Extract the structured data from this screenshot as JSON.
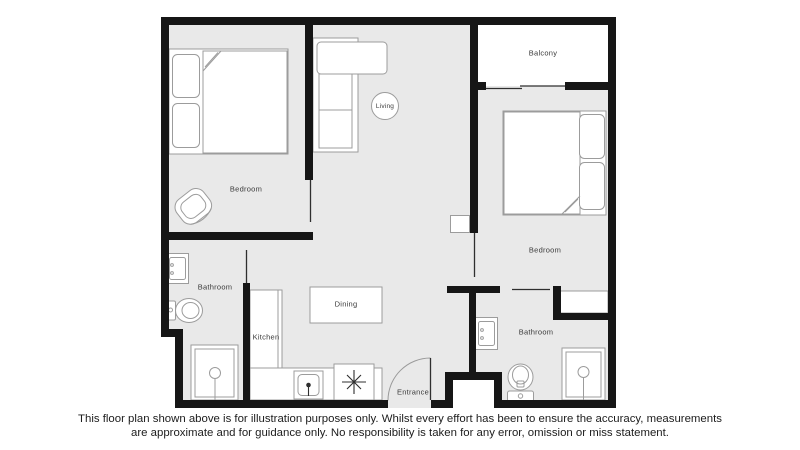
{
  "colors": {
    "wall": "#161616",
    "floor": "#e9e9e9",
    "outline": "#9c9c9c",
    "label": "#3b3b3b",
    "ink": "#1c1c1c"
  },
  "plan": {
    "labels": {
      "bedroom1": "Bedroom",
      "living": "Living",
      "balcony": "Balcony",
      "bedroom2": "Bedroom",
      "bathroom1": "Bathroom",
      "kitchen": "Kitchen",
      "dining": "Dining",
      "entrance": "Entrance",
      "bathroom2": "Bathroom"
    }
  },
  "disclaimer": {
    "line1": "This floor plan shown above is for illustration purposes only. Whilst every effort has been to ensure the accuracy, measurements",
    "line2": "are approximate and for guidance only. No responsibility is taken for any error, omission or miss statement."
  }
}
